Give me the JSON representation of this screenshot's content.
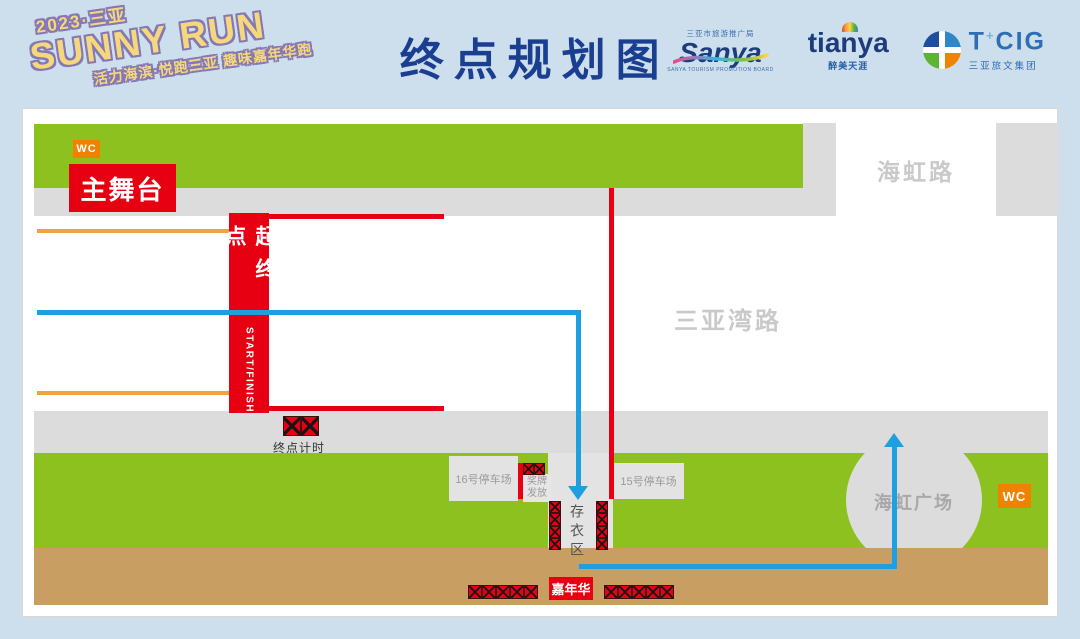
{
  "header": {
    "logo": {
      "line1": "2023·三亚",
      "line2": "SUNNY RUN",
      "line3": "活力海滨·悦跑三亚 趣味嘉年华跑"
    },
    "title": "终点规划图",
    "partners": {
      "sanya": {
        "top": "三亚市旅游推广局",
        "name": "Sanya",
        "sub": "SANYA TOURISM PROMOTION BOARD"
      },
      "tianya": {
        "name": "tianya",
        "sub": "醉美天涯"
      },
      "tcig": {
        "name_t": "T",
        "plus": "+",
        "name_rest": "CIG",
        "sub": "三亚旅文集团"
      }
    }
  },
  "map": {
    "labels": {
      "wc_top": "WC",
      "wc_right": "WC",
      "main_stage": "主舞台",
      "start_banner_cn": "起终点",
      "start_banner_en": "START/FINISH",
      "haihong_road": "海虹路",
      "sanyawan_road": "三亚湾路",
      "finish_timing": "终点计时",
      "parking16": "16号停车场",
      "parking15": "15号停车场",
      "medal_line1": "奖牌",
      "medal_line2": "发放",
      "cloakroom": "存衣区",
      "haihong_plaza": "海虹广场",
      "carnival": "嘉年华"
    },
    "counts": {
      "timing_cells": 2,
      "medal_cells": 2,
      "cloak_cells": 4,
      "carnival_left": 5,
      "carnival_right": 5
    },
    "colors": {
      "background": "#cddfec",
      "accent_red": "#e60012",
      "green": "#8cc11f",
      "road_gray": "#dcdcdc",
      "block_gray": "#e3e3e3",
      "orange_route": "#f0a43f",
      "blue_route": "#1f9ee0",
      "sand_brown": "#c89e63",
      "title_blue": "#1b3f90",
      "wc_orange": "#ef8200",
      "logo_yellow": "#f6d87c",
      "logo_purple": "#8678b5"
    }
  }
}
